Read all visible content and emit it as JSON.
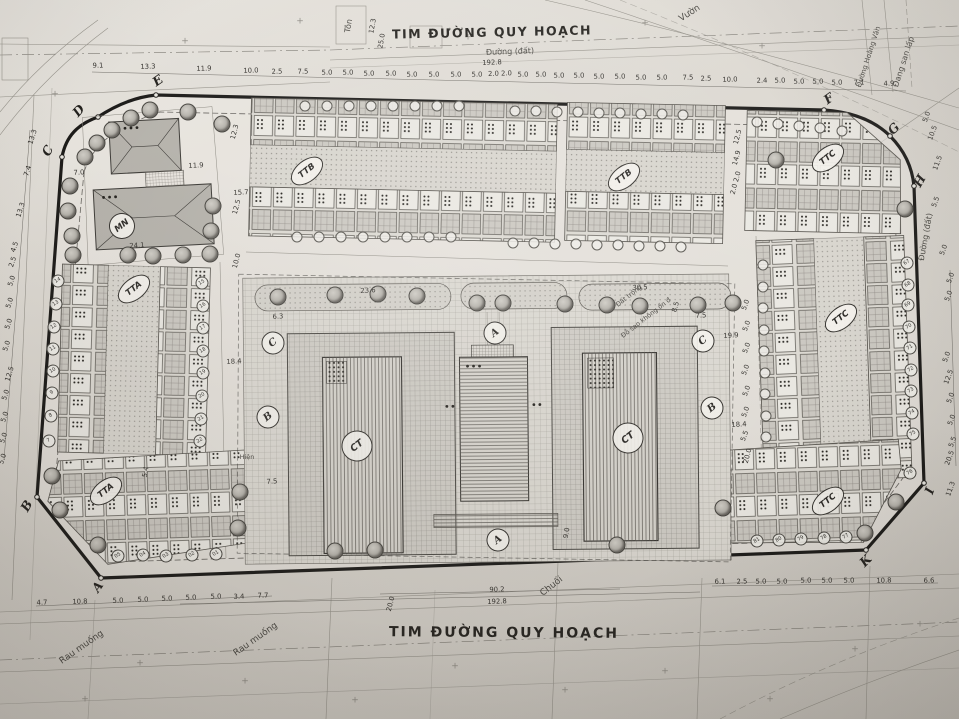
{
  "titles": {
    "top": "TIM ĐƯỜNG QUY HOẠCH",
    "bottom": "TIM ĐƯỜNG QUY HOẠCH"
  },
  "colors": {
    "paper": "#d8d4cd",
    "ink": "#3a3834",
    "boundary": "#1b1a18"
  },
  "boundary_points": [
    {
      "t": "C",
      "x": 48,
      "y": 151,
      "r": -60
    },
    {
      "t": "D",
      "x": 79,
      "y": 111,
      "r": -48
    },
    {
      "t": "E",
      "x": 158,
      "y": 81,
      "r": -35
    },
    {
      "t": "F",
      "x": 829,
      "y": 99,
      "r": -35
    },
    {
      "t": "G",
      "x": 894,
      "y": 129,
      "r": -45
    },
    {
      "t": "H",
      "x": 920,
      "y": 181,
      "r": -60
    },
    {
      "t": "I",
      "x": 930,
      "y": 491,
      "r": -70
    },
    {
      "t": "K",
      "x": 866,
      "y": 561,
      "r": -45
    },
    {
      "t": "A",
      "x": 98,
      "y": 587,
      "r": -55
    },
    {
      "t": "B",
      "x": 27,
      "y": 506,
      "r": -60
    }
  ],
  "block_labels": [
    {
      "t": "MN",
      "x": 122,
      "y": 226,
      "cls": "circle",
      "r": -38
    },
    {
      "t": "TTA",
      "x": 134,
      "y": 289,
      "cls": "oval",
      "r": -38
    },
    {
      "t": "TTA",
      "x": 106,
      "y": 491,
      "cls": "oval",
      "r": -38
    },
    {
      "t": "TTB",
      "x": 307,
      "y": 171,
      "cls": "oval",
      "r": -38
    },
    {
      "t": "TTB",
      "x": 624,
      "y": 177,
      "cls": "oval",
      "r": -38
    },
    {
      "t": "TTC",
      "x": 828,
      "y": 158,
      "cls": "oval",
      "r": -38
    },
    {
      "t": "TTC",
      "x": 841,
      "y": 318,
      "cls": "oval",
      "r": -38
    },
    {
      "t": "TTC",
      "x": 828,
      "y": 501,
      "cls": "oval",
      "r": -38
    },
    {
      "t": "CT",
      "x": 357,
      "y": 446,
      "cls": "ct",
      "r": -38
    },
    {
      "t": "CT",
      "x": 628,
      "y": 438,
      "cls": "ct",
      "r": -38
    }
  ],
  "section_markers": [
    {
      "t": "A",
      "x": 495,
      "y": 333,
      "r": -38
    },
    {
      "t": "A",
      "x": 498,
      "y": 540,
      "r": -38
    },
    {
      "t": "B",
      "x": 268,
      "y": 417,
      "r": -38
    },
    {
      "t": "B",
      "x": 712,
      "y": 408,
      "r": -38
    },
    {
      "t": "C",
      "x": 273,
      "y": 343,
      "r": -38
    },
    {
      "t": "C",
      "x": 703,
      "y": 341,
      "r": -38
    }
  ],
  "area_texts": [
    {
      "t": "Vườn",
      "x": 690,
      "y": 14,
      "r": -33,
      "s": 9
    },
    {
      "t": "Tôn",
      "x": 349,
      "y": 26,
      "r": -80,
      "s": 8
    },
    {
      "t": "Đường (đất)",
      "x": 510,
      "y": 52,
      "r": -2,
      "s": 8
    },
    {
      "t": "Đường (đất)",
      "x": 926,
      "y": 237,
      "r": -80,
      "s": 8
    },
    {
      "t": "Đang san lấp",
      "x": 904,
      "y": 62,
      "r": -72,
      "s": 8
    },
    {
      "t": "Đường Hoàng Văn",
      "x": 869,
      "y": 57,
      "r": -72,
      "s": 7
    },
    {
      "t": "Rau muống",
      "x": 82,
      "y": 648,
      "r": -35,
      "s": 9
    },
    {
      "t": "Rau muống",
      "x": 256,
      "y": 640,
      "r": -35,
      "s": 9
    },
    {
      "t": "Chuối",
      "x": 552,
      "y": 587,
      "r": -38,
      "s": 9
    },
    {
      "t": "Hiện",
      "x": 247,
      "y": 457,
      "r": 0,
      "s": 6.5
    },
    {
      "t": "Đất trống",
      "x": 629,
      "y": 296,
      "r": -38,
      "s": 6.5
    },
    {
      "t": "Đỗ sao không ổn đ",
      "x": 646,
      "y": 318,
      "r": -38,
      "s": 6.5
    }
  ],
  "dim_labels": [
    {
      "t": "9.1",
      "x": 98,
      "y": 66,
      "r": -2
    },
    {
      "t": "13.3",
      "x": 148,
      "y": 67,
      "r": -2
    },
    {
      "t": "11.9",
      "x": 204,
      "y": 69,
      "r": -2
    },
    {
      "t": "10.0",
      "x": 251,
      "y": 71,
      "r": -2
    },
    {
      "t": "2.5",
      "x": 277,
      "y": 72,
      "r": -2
    },
    {
      "t": "7.5",
      "x": 303,
      "y": 72,
      "r": -2
    },
    {
      "t": "5.0",
      "x": 327,
      "y": 73,
      "r": -2
    },
    {
      "t": "5.0",
      "x": 348,
      "y": 73,
      "r": -2
    },
    {
      "t": "5.0",
      "x": 369,
      "y": 74,
      "r": -2
    },
    {
      "t": "5.0",
      "x": 391,
      "y": 74,
      "r": -2
    },
    {
      "t": "5.0",
      "x": 412,
      "y": 75,
      "r": -2
    },
    {
      "t": "5.0",
      "x": 434,
      "y": 75,
      "r": -2
    },
    {
      "t": "5.0",
      "x": 456,
      "y": 75,
      "r": -2
    },
    {
      "t": "5.0",
      "x": 477,
      "y": 75,
      "r": -2
    },
    {
      "t": "2.0 2.0",
      "x": 500,
      "y": 74,
      "r": -2
    },
    {
      "t": "5.0",
      "x": 523,
      "y": 75,
      "r": -2
    },
    {
      "t": "5.0",
      "x": 541,
      "y": 75,
      "r": -2
    },
    {
      "t": "5.0",
      "x": 559,
      "y": 76,
      "r": -2
    },
    {
      "t": "5.0",
      "x": 579,
      "y": 76,
      "r": -2
    },
    {
      "t": "5.0",
      "x": 599,
      "y": 77,
      "r": -2
    },
    {
      "t": "5.0",
      "x": 620,
      "y": 77,
      "r": -2
    },
    {
      "t": "5.0",
      "x": 641,
      "y": 78,
      "r": -2
    },
    {
      "t": "5.0",
      "x": 662,
      "y": 78,
      "r": -2
    },
    {
      "t": "7.5",
      "x": 688,
      "y": 78,
      "r": -2
    },
    {
      "t": "2.5",
      "x": 706,
      "y": 79,
      "r": -2
    },
    {
      "t": "10.0",
      "x": 730,
      "y": 80,
      "r": -2
    },
    {
      "t": "2.4",
      "x": 762,
      "y": 81,
      "r": -2
    },
    {
      "t": "5.0",
      "x": 780,
      "y": 81,
      "r": -2
    },
    {
      "t": "5.0",
      "x": 799,
      "y": 82,
      "r": -2
    },
    {
      "t": "5.0",
      "x": 818,
      "y": 82,
      "r": -2
    },
    {
      "t": "5.0",
      "x": 837,
      "y": 83,
      "r": -2
    },
    {
      "t": "7.1",
      "x": 859,
      "y": 83,
      "r": -2
    },
    {
      "t": "4.9",
      "x": 889,
      "y": 84,
      "r": -2
    },
    {
      "t": "192.8",
      "x": 492,
      "y": 63,
      "r": -2
    },
    {
      "t": "12.3",
      "x": 373,
      "y": 26,
      "r": -80
    },
    {
      "t": "25.0",
      "x": 382,
      "y": 41,
      "r": -80
    },
    {
      "t": "13.3",
      "x": 33,
      "y": 137,
      "r": -72
    },
    {
      "t": "7.4",
      "x": 28,
      "y": 171,
      "r": -72
    },
    {
      "t": "13.3",
      "x": 21,
      "y": 210,
      "r": -72
    },
    {
      "t": "4.5",
      "x": 15,
      "y": 247,
      "r": -72
    },
    {
      "t": "2.5",
      "x": 13,
      "y": 262,
      "r": -72
    },
    {
      "t": "5.0",
      "x": 12,
      "y": 281,
      "r": -72
    },
    {
      "t": "5.0",
      "x": 10,
      "y": 303,
      "r": -72
    },
    {
      "t": "5.0",
      "x": 9,
      "y": 324,
      "r": -72
    },
    {
      "t": "5.0",
      "x": 7,
      "y": 346,
      "r": -72
    },
    {
      "t": "12.5",
      "x": 10,
      "y": 374,
      "r": -72
    },
    {
      "t": "5.0",
      "x": 6,
      "y": 395,
      "r": -72
    },
    {
      "t": "5.0",
      "x": 5,
      "y": 417,
      "r": -72
    },
    {
      "t": "5.0",
      "x": 4,
      "y": 438,
      "r": -72
    },
    {
      "t": "5.0",
      "x": 3,
      "y": 459,
      "r": -72
    },
    {
      "t": "5.0",
      "x": 927,
      "y": 117,
      "r": -70
    },
    {
      "t": "10.5",
      "x": 933,
      "y": 133,
      "r": -70
    },
    {
      "t": "11.5",
      "x": 938,
      "y": 163,
      "r": -70
    },
    {
      "t": "5.5",
      "x": 936,
      "y": 202,
      "r": -70
    },
    {
      "t": "5.0",
      "x": 944,
      "y": 250,
      "r": -70
    },
    {
      "t": "5.0",
      "x": 951,
      "y": 278,
      "r": -70
    },
    {
      "t": "5.0",
      "x": 949,
      "y": 296,
      "r": -70
    },
    {
      "t": "5.0",
      "x": 947,
      "y": 357,
      "r": -70
    },
    {
      "t": "12.5",
      "x": 949,
      "y": 377,
      "r": -70
    },
    {
      "t": "5.0",
      "x": 951,
      "y": 398,
      "r": -70
    },
    {
      "t": "5.0",
      "x": 952,
      "y": 420,
      "r": -70
    },
    {
      "t": "5.5",
      "x": 953,
      "y": 442,
      "r": -70
    },
    {
      "t": "20.5",
      "x": 950,
      "y": 458,
      "r": -70
    },
    {
      "t": "11.3",
      "x": 951,
      "y": 489,
      "r": -70
    },
    {
      "t": "12.5",
      "x": 738,
      "y": 137,
      "r": -75
    },
    {
      "t": "14.9",
      "x": 737,
      "y": 158,
      "r": -75
    },
    {
      "t": "2.0 2.0",
      "x": 736,
      "y": 183,
      "r": -75
    },
    {
      "t": "8.5",
      "x": 676,
      "y": 307,
      "r": -75
    },
    {
      "t": "7.5",
      "x": 701,
      "y": 316,
      "r": -3
    },
    {
      "t": "19.9",
      "x": 731,
      "y": 336,
      "r": -3
    },
    {
      "t": "5.0",
      "x": 746,
      "y": 305,
      "r": -70
    },
    {
      "t": "5.0",
      "x": 747,
      "y": 326,
      "r": -70
    },
    {
      "t": "5.0",
      "x": 747,
      "y": 348,
      "r": -70
    },
    {
      "t": "5.0",
      "x": 746,
      "y": 370,
      "r": -70
    },
    {
      "t": "5.0",
      "x": 747,
      "y": 391,
      "r": -70
    },
    {
      "t": "5.0",
      "x": 746,
      "y": 412,
      "r": -70
    },
    {
      "t": "18.4",
      "x": 739,
      "y": 425,
      "r": -3
    },
    {
      "t": "5.5",
      "x": 745,
      "y": 436,
      "r": -70
    },
    {
      "t": "20.0",
      "x": 748,
      "y": 456,
      "r": -75
    },
    {
      "t": "7.0",
      "x": 79,
      "y": 173,
      "r": -3
    },
    {
      "t": "11.9",
      "x": 196,
      "y": 166,
      "r": -3
    },
    {
      "t": "24.1",
      "x": 137,
      "y": 246,
      "r": -3
    },
    {
      "t": "15.7",
      "x": 241,
      "y": 193,
      "r": -3
    },
    {
      "t": "12.5",
      "x": 237,
      "y": 207,
      "r": -75
    },
    {
      "t": "12.3",
      "x": 235,
      "y": 132,
      "r": -75
    },
    {
      "t": "10.0",
      "x": 237,
      "y": 261,
      "r": -75
    },
    {
      "t": "18.4",
      "x": 234,
      "y": 362,
      "r": -3
    },
    {
      "t": "6.3",
      "x": 278,
      "y": 317,
      "r": -3
    },
    {
      "t": "7.5",
      "x": 272,
      "y": 482,
      "r": -3
    },
    {
      "t": "23.6",
      "x": 368,
      "y": 291,
      "r": -3
    },
    {
      "t": "30.5",
      "x": 640,
      "y": 288,
      "r": -3
    },
    {
      "t": "9.0",
      "x": 567,
      "y": 533,
      "r": -80
    },
    {
      "t": "20.0",
      "x": 391,
      "y": 604,
      "r": -75
    },
    {
      "t": "5.4",
      "x": 146,
      "y": 472,
      "r": -80
    },
    {
      "t": "4.7",
      "x": 42,
      "y": 603,
      "r": -2
    },
    {
      "t": "10.8",
      "x": 80,
      "y": 602,
      "r": -2
    },
    {
      "t": "5.0",
      "x": 118,
      "y": 601,
      "r": -2
    },
    {
      "t": "5.0",
      "x": 143,
      "y": 600,
      "r": -2
    },
    {
      "t": "5.0",
      "x": 167,
      "y": 599,
      "r": -2
    },
    {
      "t": "5.0",
      "x": 191,
      "y": 598,
      "r": -2
    },
    {
      "t": "5.0",
      "x": 216,
      "y": 597,
      "r": -2
    },
    {
      "t": "3.4",
      "x": 239,
      "y": 597,
      "r": -2
    },
    {
      "t": "7.7",
      "x": 263,
      "y": 596,
      "r": -2
    },
    {
      "t": "90.2",
      "x": 497,
      "y": 590,
      "r": -2
    },
    {
      "t": "192.8",
      "x": 497,
      "y": 602,
      "r": -2
    },
    {
      "t": "6.1",
      "x": 720,
      "y": 582,
      "r": -2
    },
    {
      "t": "2.5",
      "x": 742,
      "y": 582,
      "r": -2
    },
    {
      "t": "5.0",
      "x": 761,
      "y": 582,
      "r": -2
    },
    {
      "t": "5.0",
      "x": 782,
      "y": 582,
      "r": -2
    },
    {
      "t": "5.0",
      "x": 806,
      "y": 581,
      "r": -2
    },
    {
      "t": "5.0",
      "x": 827,
      "y": 581,
      "r": -2
    },
    {
      "t": "5.0",
      "x": 849,
      "y": 581,
      "r": -2
    },
    {
      "t": "10.8",
      "x": 884,
      "y": 581,
      "r": -2
    },
    {
      "t": "6.6",
      "x": 929,
      "y": 581,
      "r": -2
    }
  ],
  "lot_numbers": [
    {
      "t": "14",
      "x": 58,
      "y": 281
    },
    {
      "t": "13",
      "x": 56,
      "y": 304
    },
    {
      "t": "12",
      "x": 54,
      "y": 327
    },
    {
      "t": "11",
      "x": 53,
      "y": 349
    },
    {
      "t": "10",
      "x": 53,
      "y": 371
    },
    {
      "t": "9",
      "x": 52,
      "y": 393
    },
    {
      "t": "8",
      "x": 51,
      "y": 416
    },
    {
      "t": "7",
      "x": 49,
      "y": 441
    },
    {
      "t": "15",
      "x": 202,
      "y": 283
    },
    {
      "t": "16",
      "x": 203,
      "y": 306
    },
    {
      "t": "17",
      "x": 203,
      "y": 328
    },
    {
      "t": "18",
      "x": 203,
      "y": 351
    },
    {
      "t": "19",
      "x": 203,
      "y": 373
    },
    {
      "t": "20",
      "x": 202,
      "y": 396
    },
    {
      "t": "21",
      "x": 201,
      "y": 419
    },
    {
      "t": "22",
      "x": 200,
      "y": 441
    },
    {
      "t": "05",
      "x": 118,
      "y": 556
    },
    {
      "t": "04",
      "x": 143,
      "y": 555
    },
    {
      "t": "03",
      "x": 166,
      "y": 556
    },
    {
      "t": "02",
      "x": 192,
      "y": 555
    },
    {
      "t": "01",
      "x": 216,
      "y": 554
    },
    {
      "t": "81",
      "x": 757,
      "y": 541
    },
    {
      "t": "80",
      "x": 779,
      "y": 540
    },
    {
      "t": "79",
      "x": 801,
      "y": 539
    },
    {
      "t": "78",
      "x": 824,
      "y": 538
    },
    {
      "t": "77",
      "x": 846,
      "y": 537
    },
    {
      "t": "67",
      "x": 907,
      "y": 263
    },
    {
      "t": "68",
      "x": 908,
      "y": 285
    },
    {
      "t": "69",
      "x": 908,
      "y": 305
    },
    {
      "t": "70",
      "x": 909,
      "y": 327
    },
    {
      "t": "71",
      "x": 910,
      "y": 348
    },
    {
      "t": "72",
      "x": 911,
      "y": 370
    },
    {
      "t": "73",
      "x": 911,
      "y": 391
    },
    {
      "t": "74",
      "x": 912,
      "y": 413
    },
    {
      "t": "75",
      "x": 913,
      "y": 434
    },
    {
      "t": "76",
      "x": 910,
      "y": 473
    }
  ],
  "lot_markers": [
    {
      "x": 305,
      "y": 106
    },
    {
      "x": 327,
      "y": 106
    },
    {
      "x": 349,
      "y": 106
    },
    {
      "x": 371,
      "y": 106
    },
    {
      "x": 393,
      "y": 106
    },
    {
      "x": 415,
      "y": 106
    },
    {
      "x": 437,
      "y": 106
    },
    {
      "x": 459,
      "y": 106
    },
    {
      "x": 297,
      "y": 237
    },
    {
      "x": 319,
      "y": 237
    },
    {
      "x": 341,
      "y": 237
    },
    {
      "x": 363,
      "y": 237
    },
    {
      "x": 385,
      "y": 237
    },
    {
      "x": 407,
      "y": 237
    },
    {
      "x": 429,
      "y": 237
    },
    {
      "x": 451,
      "y": 237
    },
    {
      "x": 515,
      "y": 111
    },
    {
      "x": 536,
      "y": 111
    },
    {
      "x": 557,
      "y": 112
    },
    {
      "x": 578,
      "y": 112
    },
    {
      "x": 599,
      "y": 113
    },
    {
      "x": 620,
      "y": 113
    },
    {
      "x": 641,
      "y": 114
    },
    {
      "x": 662,
      "y": 114
    },
    {
      "x": 683,
      "y": 115
    },
    {
      "x": 513,
      "y": 243
    },
    {
      "x": 534,
      "y": 243
    },
    {
      "x": 555,
      "y": 244
    },
    {
      "x": 576,
      "y": 244
    },
    {
      "x": 597,
      "y": 245
    },
    {
      "x": 618,
      "y": 245
    },
    {
      "x": 639,
      "y": 246
    },
    {
      "x": 660,
      "y": 246
    },
    {
      "x": 681,
      "y": 247
    },
    {
      "x": 763,
      "y": 265
    },
    {
      "x": 763,
      "y": 287
    },
    {
      "x": 763,
      "y": 308
    },
    {
      "x": 764,
      "y": 330
    },
    {
      "x": 764,
      "y": 351
    },
    {
      "x": 765,
      "y": 373
    },
    {
      "x": 765,
      "y": 394
    },
    {
      "x": 766,
      "y": 416
    },
    {
      "x": 766,
      "y": 437
    },
    {
      "x": 757,
      "y": 122
    },
    {
      "x": 778,
      "y": 124
    },
    {
      "x": 799,
      "y": 126
    },
    {
      "x": 820,
      "y": 128
    },
    {
      "x": 842,
      "y": 131
    }
  ],
  "trees": [
    {
      "x": 85,
      "y": 157
    },
    {
      "x": 97,
      "y": 143
    },
    {
      "x": 112,
      "y": 130
    },
    {
      "x": 131,
      "y": 118
    },
    {
      "x": 150,
      "y": 110
    },
    {
      "x": 188,
      "y": 112
    },
    {
      "x": 222,
      "y": 124
    },
    {
      "x": 70,
      "y": 186
    },
    {
      "x": 68,
      "y": 211
    },
    {
      "x": 72,
      "y": 236
    },
    {
      "x": 213,
      "y": 206
    },
    {
      "x": 211,
      "y": 231
    },
    {
      "x": 73,
      "y": 255
    },
    {
      "x": 128,
      "y": 255
    },
    {
      "x": 153,
      "y": 256
    },
    {
      "x": 183,
      "y": 255
    },
    {
      "x": 210,
      "y": 254
    },
    {
      "x": 278,
      "y": 297
    },
    {
      "x": 335,
      "y": 295
    },
    {
      "x": 378,
      "y": 294
    },
    {
      "x": 417,
      "y": 296
    },
    {
      "x": 477,
      "y": 303
    },
    {
      "x": 503,
      "y": 303
    },
    {
      "x": 565,
      "y": 304
    },
    {
      "x": 607,
      "y": 305
    },
    {
      "x": 640,
      "y": 306
    },
    {
      "x": 698,
      "y": 305
    },
    {
      "x": 733,
      "y": 303
    },
    {
      "x": 776,
      "y": 160
    },
    {
      "x": 905,
      "y": 209
    },
    {
      "x": 60,
      "y": 510
    },
    {
      "x": 52,
      "y": 476
    },
    {
      "x": 98,
      "y": 545
    },
    {
      "x": 240,
      "y": 492
    },
    {
      "x": 238,
      "y": 528
    },
    {
      "x": 335,
      "y": 551
    },
    {
      "x": 375,
      "y": 550
    },
    {
      "x": 617,
      "y": 545
    },
    {
      "x": 723,
      "y": 508
    },
    {
      "x": 865,
      "y": 533
    },
    {
      "x": 896,
      "y": 502
    }
  ],
  "crosses": [
    {
      "x": 185,
      "y": 42
    },
    {
      "x": 300,
      "y": 22
    },
    {
      "x": 468,
      "y": 38
    },
    {
      "x": 645,
      "y": 24
    },
    {
      "x": 762,
      "y": 47
    },
    {
      "x": 55,
      "y": 95
    },
    {
      "x": 140,
      "y": 664
    },
    {
      "x": 245,
      "y": 682
    },
    {
      "x": 355,
      "y": 701
    },
    {
      "x": 455,
      "y": 667
    },
    {
      "x": 565,
      "y": 691
    },
    {
      "x": 665,
      "y": 672
    },
    {
      "x": 770,
      "y": 700
    },
    {
      "x": 855,
      "y": 650
    },
    {
      "x": 920,
      "y": 625
    },
    {
      "x": 85,
      "y": 700
    }
  ]
}
